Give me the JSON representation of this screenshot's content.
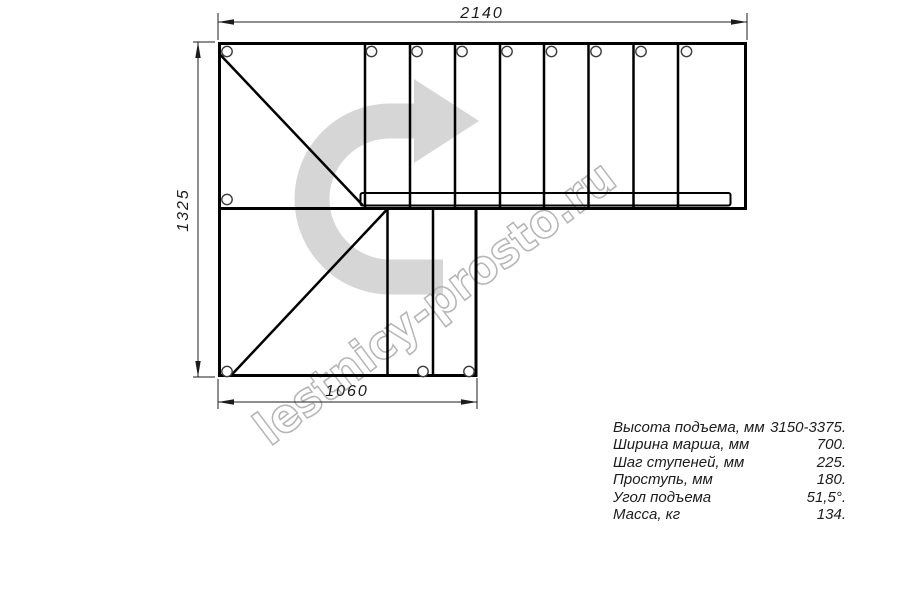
{
  "dimensions": {
    "top": "2140",
    "left": "1325",
    "bottom": "1060"
  },
  "watermark": {
    "text": "lestnicy-prosto.ru"
  },
  "specs": {
    "rows": [
      {
        "label": "Высота подъема, мм",
        "value": "3150-3375."
      },
      {
        "label": "Ширина марша, мм",
        "value": "700."
      },
      {
        "label": "Шаг ступеней, мм",
        "value": "225."
      },
      {
        "label": "Проступь, мм",
        "value": "180."
      },
      {
        "label": "Угол подъема",
        "value": "51,5°."
      },
      {
        "label": "Масса, кг",
        "value": "134."
      }
    ]
  },
  "colors": {
    "line": "#000000",
    "dimension": "#1c1c1c",
    "arrow": "#d6d6d6",
    "watermark_outline": "#b5b5b5"
  }
}
